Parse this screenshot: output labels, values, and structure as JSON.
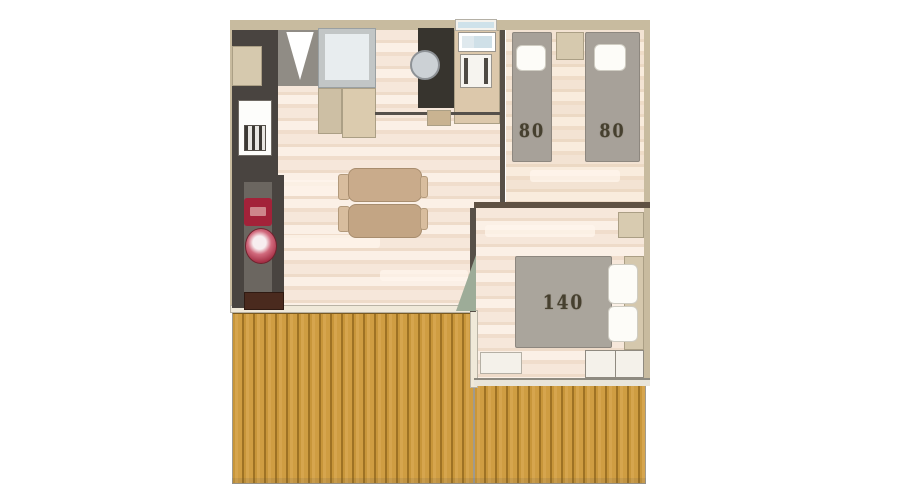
{
  "type": "floor-plan",
  "rooms": {
    "twin_bedroom": {
      "bed_left_label": "80",
      "bed_right_label": "80"
    },
    "double_bedroom": {
      "bed_label": "140"
    }
  },
  "palette": {
    "deck_wood": "#cf9d42",
    "deck_gap": "#9e7224",
    "floor_light": "#f6e7da",
    "wall_tan": "#c8bb9f",
    "wall_dark": "#575048",
    "bed_gray": "#a7a199",
    "pillow_white": "#fdfcf8",
    "label_ink": "#46402f",
    "emblem_red": "#a32239",
    "rug_pink": "#d16a7d",
    "door_sage": "#9dac98",
    "bathroom_dark": "#494440",
    "kitchen_window_blue": "#cfe2ea"
  }
}
